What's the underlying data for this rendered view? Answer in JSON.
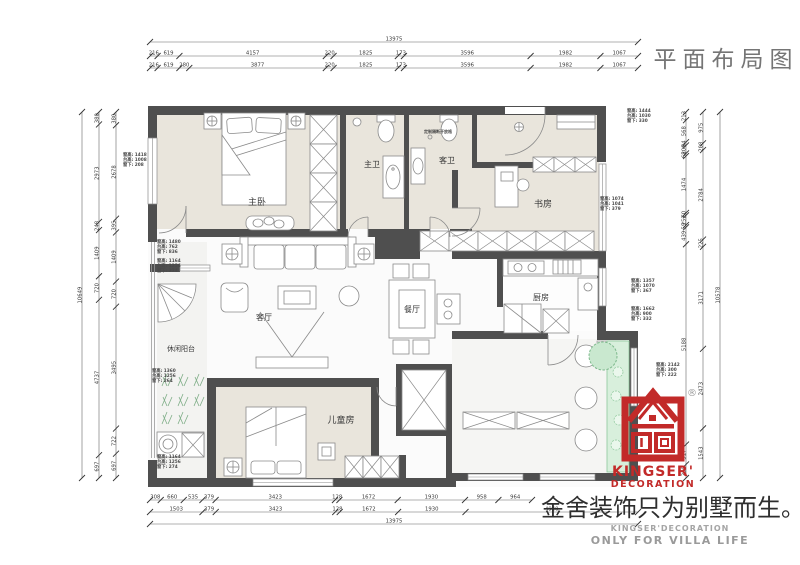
{
  "header": {
    "title": "平面布局图"
  },
  "rooms": [
    {
      "label": "主卧",
      "x": 257,
      "y": 205,
      "size": 9
    },
    {
      "label": "主卫",
      "x": 372,
      "y": 167,
      "size": 8
    },
    {
      "label": "客卫",
      "x": 447,
      "y": 163,
      "size": 8
    },
    {
      "label": "书房",
      "x": 543,
      "y": 207,
      "size": 9
    },
    {
      "label": "厨房",
      "x": 541,
      "y": 300,
      "size": 8
    },
    {
      "label": "餐厅",
      "x": 412,
      "y": 312,
      "size": 8
    },
    {
      "label": "客厅",
      "x": 264,
      "y": 320,
      "size": 8
    },
    {
      "label": "休闲阳台",
      "x": 181,
      "y": 351,
      "size": 7
    },
    {
      "label": "儿童房",
      "x": 341,
      "y": 423,
      "size": 9
    }
  ],
  "annotations": {
    "partition_note": "定制隔断开放格",
    "window_notes": [
      {
        "x": 123,
        "y": 156,
        "lines": [
          "窗高: 1418",
          "台高: 1008",
          "窗下: 208"
        ]
      },
      {
        "x": 157,
        "y": 243,
        "lines": [
          "窗高: 1480",
          "台高: 762",
          "窗下: 836"
        ]
      },
      {
        "x": 157,
        "y": 262,
        "lines": [
          "窗高: 1164",
          "台高: 1256",
          "窗下: 274"
        ]
      },
      {
        "x": 152,
        "y": 372,
        "lines": [
          "窗高: 1360",
          "台高: 1256",
          "窗下: 264"
        ]
      },
      {
        "x": 157,
        "y": 458,
        "lines": [
          "窗高: 1164",
          "台高: 1256",
          "窗下: 274"
        ]
      },
      {
        "x": 627,
        "y": 112,
        "lines": [
          "窗高: 1444",
          "台高: 1030",
          "窗下: 330"
        ]
      },
      {
        "x": 600,
        "y": 200,
        "lines": [
          "窗高: 1074",
          "台高: 1041",
          "窗下: 379"
        ]
      },
      {
        "x": 631,
        "y": 282,
        "lines": [
          "窗高: 1357",
          "台高: 1070",
          "窗下: 367"
        ]
      },
      {
        "x": 631,
        "y": 310,
        "lines": [
          "窗高: 1662",
          "台高: 900",
          "窗下: 332"
        ]
      },
      {
        "x": 656,
        "y": 366,
        "lines": [
          "窗高: 2142",
          "台高: 300",
          "窗下: 222"
        ]
      }
    ]
  },
  "dimensions": {
    "top": [
      [
        "13975"
      ],
      [
        "216",
        "619",
        "4157",
        "220",
        "1825",
        "173",
        "3596",
        "1982",
        "1067"
      ],
      [
        "216",
        "619",
        "280",
        "3877",
        "220",
        "1825",
        "173",
        "3596",
        "1982",
        "1067"
      ]
    ],
    "bottom": [
      [
        "308",
        "660",
        "535",
        "379",
        "3423",
        "128",
        "1672",
        "1930",
        "958",
        "964"
      ],
      [
        "1503",
        "379",
        "3423",
        "128",
        "1672",
        "1930",
        "4940"
      ],
      [
        "13975"
      ]
    ],
    "left": [
      [
        "10649"
      ],
      [
        "380",
        "2973",
        "248",
        "1409",
        "720",
        "4737",
        "697"
      ],
      [
        "380",
        "2678",
        "395",
        "1409",
        "720",
        "3495",
        "722",
        "697"
      ]
    ],
    "right": [
      [
        "213",
        "568",
        "84",
        "209",
        "68",
        "1474",
        "60",
        "252",
        "59",
        "439",
        "5188",
        "517",
        "350"
      ],
      [
        "975",
        "208",
        "2784",
        "225",
        "3171",
        "2473",
        "1543"
      ],
      [
        "10578"
      ]
    ]
  },
  "branding": {
    "brand_line1": "KINGSER'",
    "brand_line2": "DECORATION",
    "registered": "®",
    "slogan": "金舍装饰只为别墅而生。",
    "sub_en1": "KINGSER'DECORATION",
    "sub_en2": "ONLY FOR VILLA LIFE"
  },
  "colors": {
    "wall": "#4f4f4f",
    "room_beige": "#e9e5dc",
    "floor_light": "#fbfbfb",
    "balcony_gray": "#f3f3f1",
    "plant_green": "#d8efdc",
    "plant_stroke": "#8cc79a",
    "brand_red": "#c22a29",
    "line_gray": "#8a8a8a",
    "dim_gray": "#3a3a3a"
  }
}
